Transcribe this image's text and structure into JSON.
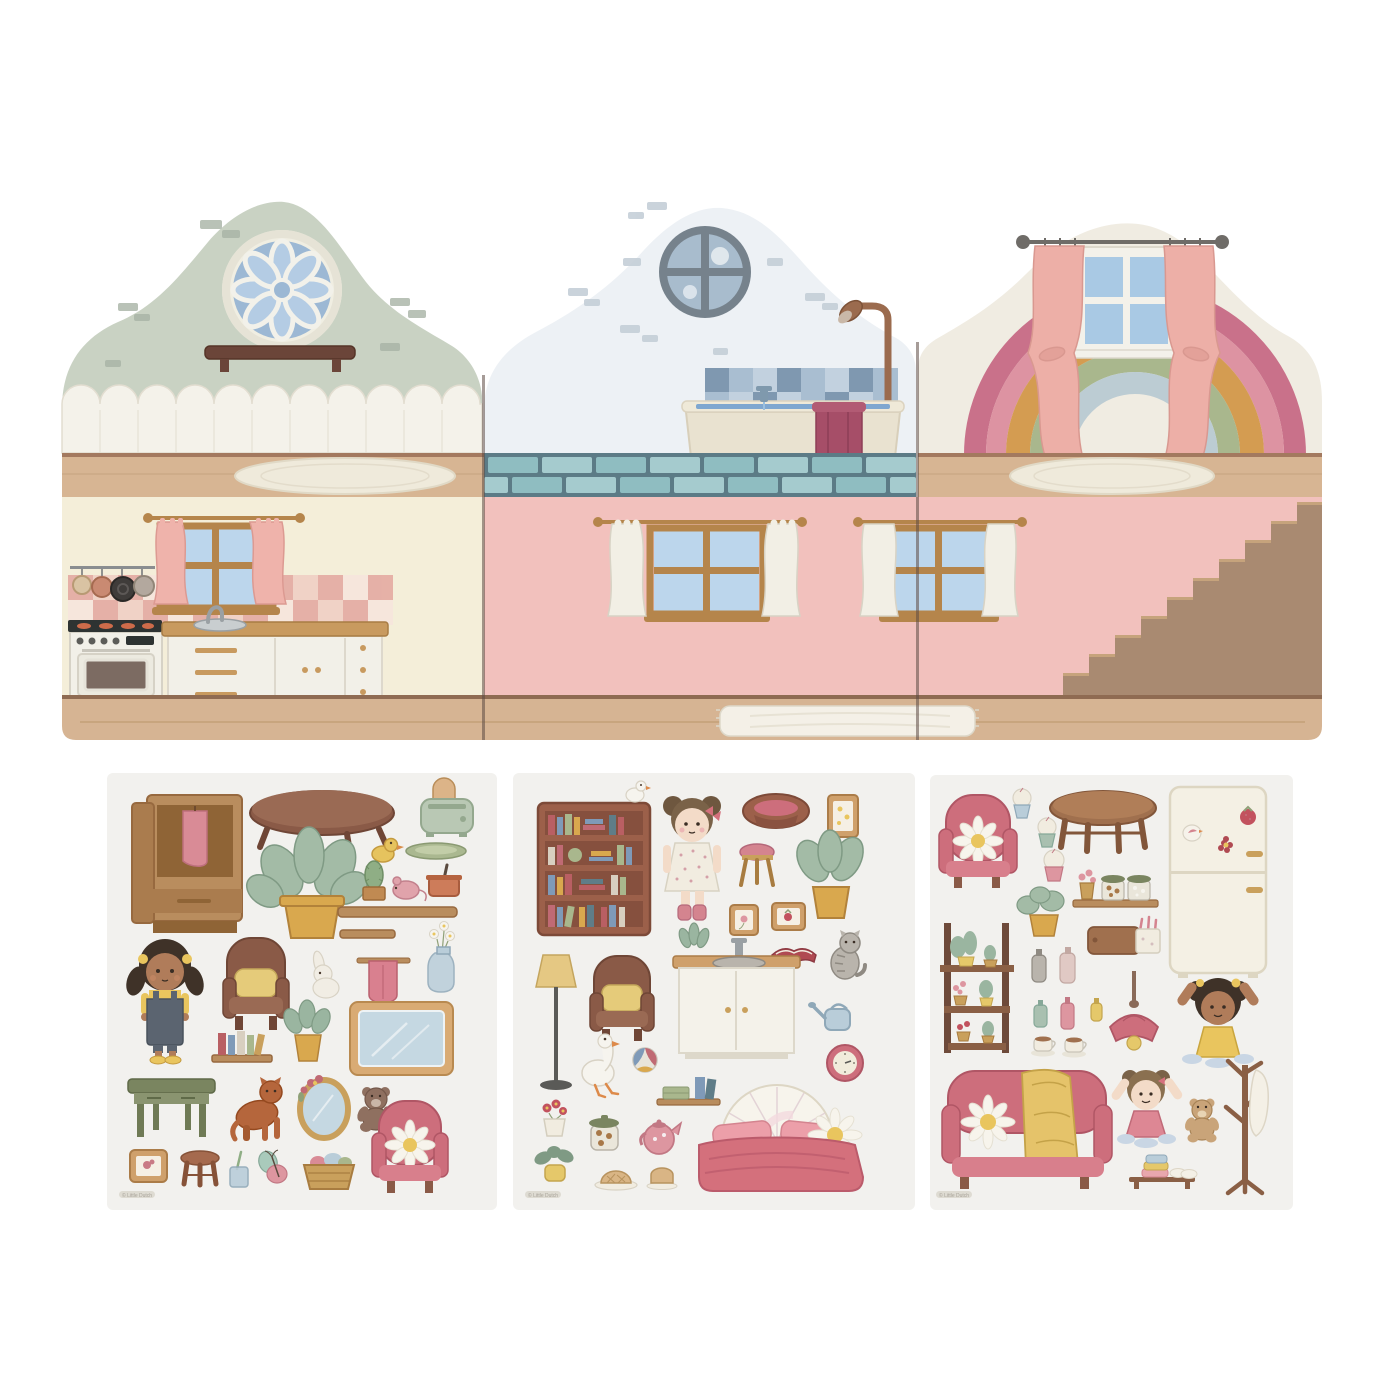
{
  "watermark": "© Little Dutch",
  "dollhouse": {
    "panels": [
      {
        "id": "left-panel",
        "rooms": [
          "living-room",
          "kitchen"
        ],
        "features": [
          "rosette-window",
          "wall-shelf",
          "picket-wainscot",
          "oval-rug",
          "kitchen-window-pink-curtains",
          "pan-rack",
          "stove",
          "counter-with-sink",
          "checker-backsplash"
        ],
        "wall_colors": {
          "upper": "#c9d2c3",
          "lower": "#f4eed9"
        }
      },
      {
        "id": "middle-panel",
        "rooms": [
          "bathroom",
          "pink-room"
        ],
        "features": [
          "porthole-window",
          "shower",
          "bathtub-with-towel",
          "blue-tile-wall",
          "teal-brick-band",
          "two-windows-white-curtains",
          "fringed-rug"
        ],
        "wall_colors": {
          "upper": "#edf1f5",
          "lower": "#f2c1bd"
        }
      },
      {
        "id": "right-panel",
        "rooms": [
          "rainbow-room",
          "stair-room"
        ],
        "features": [
          "rainbow",
          "window-pink-curtains",
          "oval-rug",
          "staircase"
        ],
        "wall_colors": {
          "upper": "#f0ece2",
          "lower": "#f2c1bd"
        }
      }
    ]
  },
  "sticker_sheets": [
    {
      "id": "sheet-1",
      "background": "#f2f1ee",
      "items": [
        "wardrobe",
        "coffee-table",
        "toaster",
        "rubber-duck",
        "serving-tray",
        "potted-plant",
        "cactus",
        "toy-mouse",
        "cooking-pot",
        "wall-shelf",
        "wall-shelf-small",
        "towel-rail",
        "flower-vase",
        "doll-girl",
        "armchair-yellow-cushion",
        "bunny",
        "book-shelf",
        "potted-plant-small",
        "mirror-board",
        "green-desk",
        "cat",
        "oval-mirror",
        "teddy-bear",
        "pink-armchair-daisy",
        "picture-frame-bird",
        "stool",
        "toothbrush-cup",
        "butterfly",
        "laundry-basket"
      ]
    },
    {
      "id": "sheet-2",
      "background": "#f2f1ee",
      "items": [
        "bookcase-with-goose",
        "doll-rosa",
        "pet-basket",
        "picture-frame",
        "pink-stool",
        "potted-plant",
        "picture-frame-flower",
        "picture-frame-strawberry",
        "open-book",
        "cat-grey",
        "floor-lamp",
        "armchair-yellow-cushion",
        "sink-cabinet",
        "watering-can",
        "wall-clock",
        "goose",
        "ball",
        "shelf-with-linen",
        "flower-pot",
        "cookie-jar",
        "teapot",
        "lemon-plant",
        "pie-plate",
        "bread-slice",
        "pink-bed-daisy"
      ]
    },
    {
      "id": "sheet-3",
      "background": "#f2f1ee",
      "items": [
        "pink-armchair-daisy",
        "cupcakes",
        "round-table",
        "fridge-with-magnets",
        "spice-shelf",
        "potted-plant",
        "plant-ladder",
        "cutting-board",
        "cosmetic-bottles",
        "tea-cups",
        "pendant-lamp",
        "doll-girl-yellow",
        "pink-sofa-blanket",
        "doll-girl-pink",
        "teddy-bear-small",
        "coat-rack",
        "towel-bench"
      ]
    }
  ],
  "colors": {
    "pink": "#d4707c",
    "sage": "#c9d2c3",
    "teal_tile": "#8fbdc1",
    "wood": "#c89a5f",
    "wall_pink": "#f2c1bd",
    "cream": "#f4eed9",
    "sky_blue": "#bcd6ec",
    "rainbow": [
      "#c9718a",
      "#dd93a2",
      "#d49c51",
      "#a9b78d",
      "#bcccd3"
    ]
  }
}
